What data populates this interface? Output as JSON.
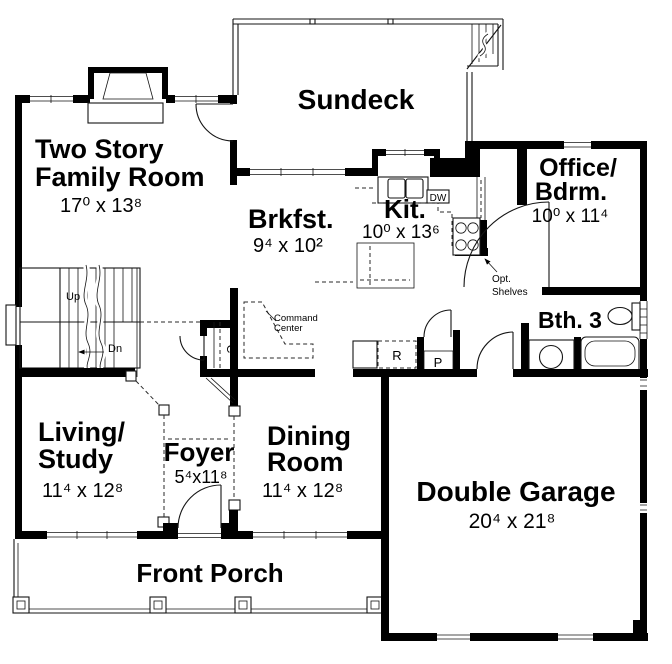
{
  "plan": {
    "rooms": {
      "sundeck": {
        "name": "Sundeck"
      },
      "family_room": {
        "line1": "Two Story",
        "line2": "Family Room",
        "dims": "17⁰ x 13⁸"
      },
      "breakfast": {
        "name": "Brkfst.",
        "dims": "9⁴ x 10²"
      },
      "kitchen": {
        "name": "Kit.",
        "dims": "10⁰ x 13⁶"
      },
      "office_bedroom": {
        "line1": "Office/",
        "line2": "Bdrm.",
        "dims": "10⁰ x 11⁴"
      },
      "bath3": {
        "name": "Bth. 3"
      },
      "living_study": {
        "line1": "Living/",
        "line2": "Study",
        "dims": "11⁴ x 12⁸"
      },
      "foyer": {
        "name": "Foyer",
        "dims": "5⁴x11⁸"
      },
      "dining_room": {
        "line1": "Dining",
        "line2": "Room",
        "dims": "11⁴ x 12⁸"
      },
      "garage": {
        "name": "Double Garage",
        "dims": "20⁴ x 21⁸"
      },
      "front_porch": {
        "name": "Front Porch"
      }
    },
    "annotations": {
      "stairs_up": "Up",
      "stairs_down": "Dn",
      "dishwasher": "DW",
      "command_center_line1": "Command",
      "command_center_line2": "Center",
      "optional_shelves_line1": "Opt.",
      "optional_shelves_line2": "Shelves",
      "closet": "C",
      "refrigerator": "R",
      "pantry": "P"
    },
    "colors": {
      "walls": "#000000",
      "thin_lines": "#141414",
      "background": "#ffffff"
    }
  }
}
